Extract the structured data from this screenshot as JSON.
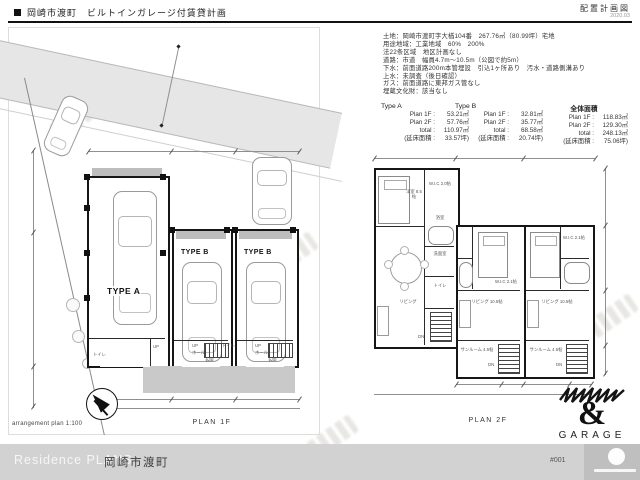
{
  "header": {
    "title": "岡崎市渡町　ビルトインガレージ付賃貸計画",
    "doc_type": "配置計画図",
    "doc_date": "2020.03"
  },
  "site_info": {
    "lines": [
      "土地：岡崎市渡町字大楢104番　267.76㎡（80.99坪）宅地",
      "用途地域：工業地域　60%　200%",
      "法22条区域　地区計画なし",
      "道路：市道　幅員4.7m〜10.5m（公図で約5m）",
      "下水：前面道路200m本管埋設　引込1ヶ所あり　汚水・道路側溝あり",
      "上水：未調査（後日確認）",
      "ガス：前面道路に東邦ガス管なし",
      "埋蔵文化財：該当なし"
    ]
  },
  "area_table": {
    "columns": [
      {
        "name": "Type A",
        "rows": [
          {
            "label": "Plan 1F :",
            "value": "53.21㎡"
          },
          {
            "label": "Plan 2F :",
            "value": "57.76㎡"
          },
          {
            "label": "total :",
            "value": "110.97㎡"
          },
          {
            "label": "(延床面積 :",
            "value": "33.57坪)"
          }
        ]
      },
      {
        "name": "Type B",
        "rows": [
          {
            "label": "Plan 1F :",
            "value": "32.81㎡"
          },
          {
            "label": "Plan 2F :",
            "value": "35.77㎡"
          },
          {
            "label": "total :",
            "value": "68.58㎡"
          },
          {
            "label": "(延床面積 :",
            "value": "20.74坪)"
          }
        ]
      },
      {
        "name": "全体面積",
        "rows": [
          {
            "label": "Plan 1F :",
            "value": "118.83㎡"
          },
          {
            "label": "Plan 2F :",
            "value": "129.30㎡"
          },
          {
            "label": "total :",
            "value": "248.13㎡"
          },
          {
            "label": "(延床面積 :",
            "value": "75.06坪)"
          }
        ]
      }
    ]
  },
  "plan1f": {
    "caption": "PLAN 1F",
    "unit_labels": [
      "TYPE A",
      "TYPE B",
      "TYPE B"
    ],
    "room_labels": {
      "up": "UP",
      "hall": "ホール",
      "genkan": "玄関",
      "toilet": "トイレ"
    }
  },
  "plan2f": {
    "caption": "PLAN 2F",
    "rooms": {
      "bedroom": "洋室 8.5帖",
      "wic_a": "W.I.C 2.0帖",
      "living_a": "リビング",
      "washroom": "洗面室",
      "bath": "浴室",
      "toilet": "トイレ",
      "wic_b": "W.I.C 2.1帖",
      "living_b": "リビング 10.5帖",
      "sunroom": "サンルーム 4.5帖",
      "dn": "DN"
    }
  },
  "arrangement": {
    "caption": "arrangement plan 1:100"
  },
  "logo": {
    "amp": "&",
    "name": "GARAGE"
  },
  "footer": {
    "brand": "Residence PLANS",
    "project": "岡崎市渡町",
    "sheet": "#001"
  },
  "colors": {
    "ink": "#161616",
    "road": "#e6e6e6",
    "drive": "#c9c9c9",
    "footer_bar": "#d2d2d2"
  }
}
